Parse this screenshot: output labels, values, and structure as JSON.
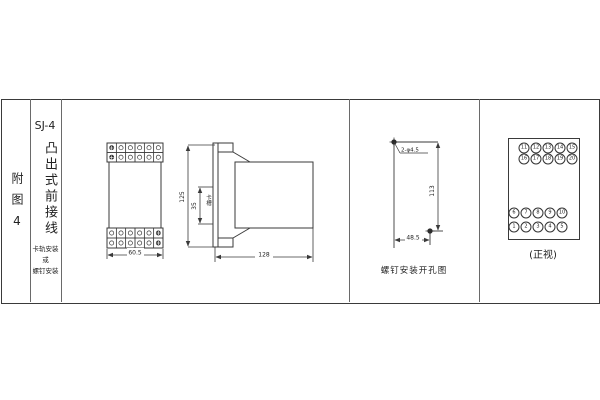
{
  "sidebar": {
    "figure_label": "附图4"
  },
  "header": {
    "model": "SJ-4",
    "type_name": "凸出式前接线",
    "mount_lines": [
      "卡轨安装",
      "或",
      "螺钉安装"
    ]
  },
  "front_view": {
    "width_dim": "60.5"
  },
  "side_view": {
    "height_dim": "125",
    "slot_dim": "35",
    "slot_label": "卡槽",
    "depth_dim": "128"
  },
  "drill_view": {
    "holes_label": "2-φ4.5",
    "height_dim": "113",
    "width_dim": "48.5",
    "caption": "螺钉安装开孔图"
  },
  "terminal_view": {
    "caption": "(正视)",
    "rows": [
      [
        11,
        12,
        13,
        14,
        15
      ],
      [
        16,
        17,
        18,
        19,
        20
      ],
      [
        6,
        7,
        8,
        9,
        10
      ],
      [
        1,
        2,
        3,
        4,
        5
      ]
    ]
  }
}
